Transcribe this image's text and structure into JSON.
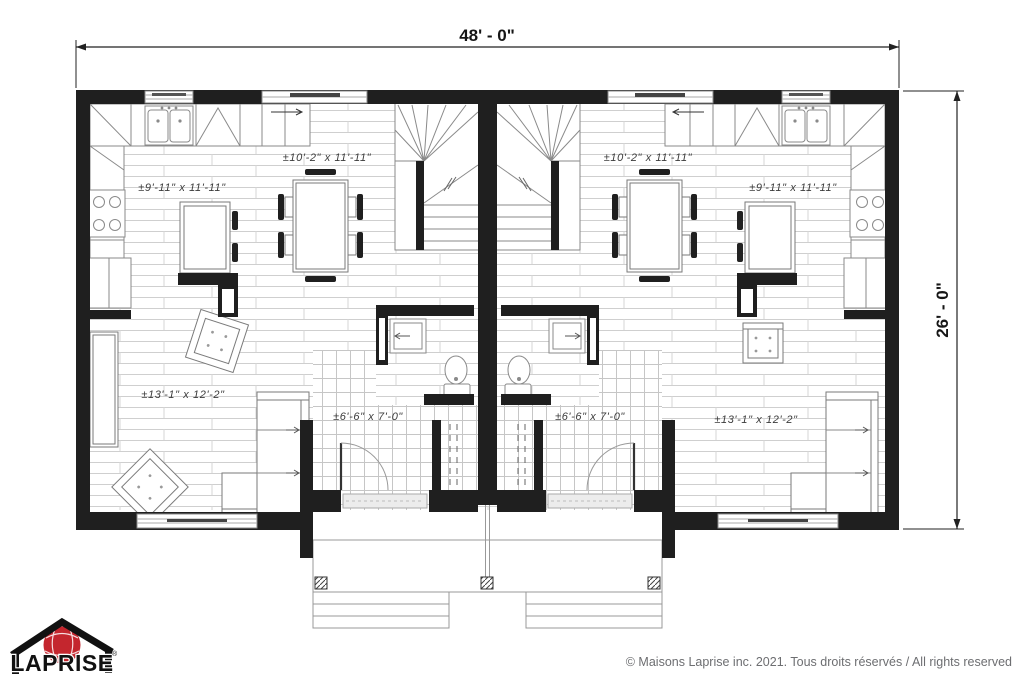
{
  "plan": {
    "dimensions": {
      "width_label": "48' - 0\"",
      "height_label": "26' - 0\""
    },
    "units": {
      "left": {
        "dining_label": "±10'-2\" x 11'-11\"",
        "kitchen_label": "±9'-11\" x 11'-11\"",
        "living_label": "±13'-1\" x 12'-2\"",
        "vestibule_label": "±6'-6\" x 7'-0\""
      },
      "right": {
        "dining_label": "±10'-2\" x 11'-11\"",
        "kitchen_label": "±9'-11\" x 11'-11\"",
        "living_label": "±13'-1\" x 12'-2\"",
        "vestibule_label": "±6'-6\" x 7'-0\""
      }
    }
  },
  "branding": {
    "logo_text": "LAPRISE",
    "registered_mark": "®"
  },
  "footer": {
    "copyright": "© Maisons Laprise inc. 2021. Tous droits réservés / All rights reserved"
  },
  "colors": {
    "wall": "#1f1f1f",
    "logo_red": "#c4262e",
    "text_gray": "#6d6e71"
  }
}
